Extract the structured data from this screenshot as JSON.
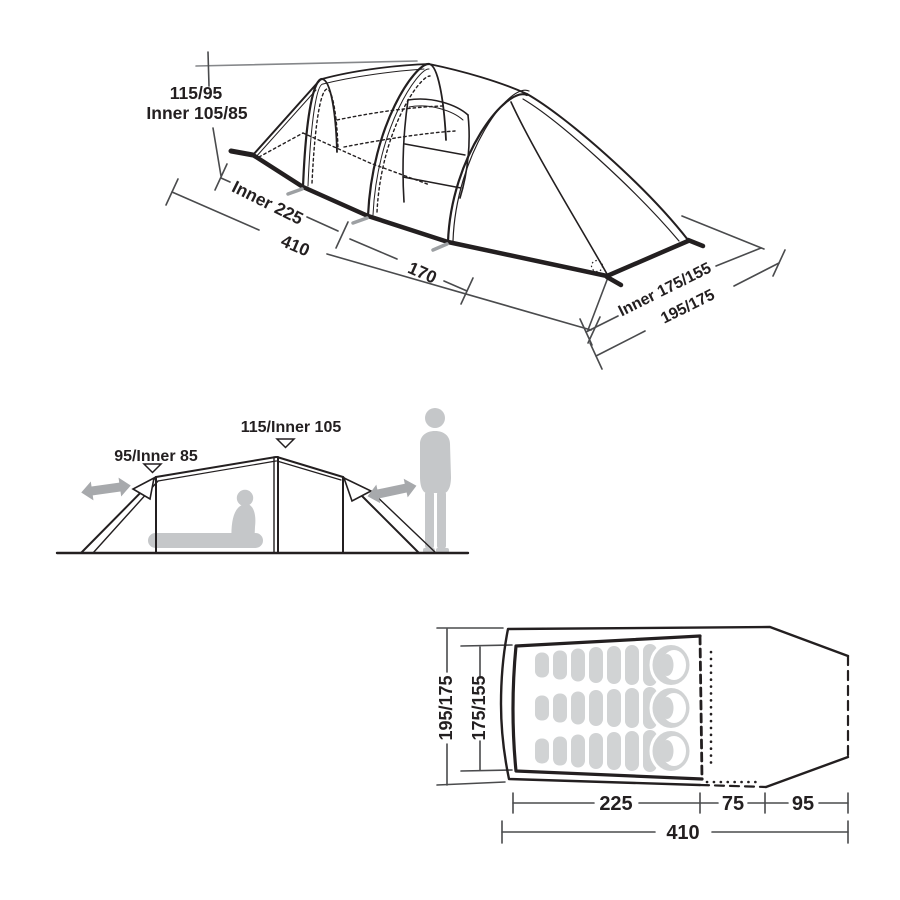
{
  "colors": {
    "line_art": "#231f20",
    "dimension_line": "#4a4b4d",
    "reference_line": "#85878a",
    "silhouette_gray": "#c5c7c9",
    "arrow_gray": "#a7a9ac",
    "sleeping_bag_gray": "#d1d3d4",
    "background": "#ffffff"
  },
  "perspective_view": {
    "peak_height_label": "115/95",
    "inner_height_label": "Inner 105/85",
    "inner_length_label": "Inner 225",
    "total_length_label": "410",
    "porch_length_label": "170",
    "inner_width_label": "Inner 175/155",
    "outer_width_label": "195/175"
  },
  "side_view": {
    "front_pole_height_label": "95/Inner 85",
    "main_pole_height_label": "115/Inner 105"
  },
  "floor_plan": {
    "outer_width_label": "195/175",
    "inner_width_label": "175/155",
    "inner_length_label": "225",
    "door_depth_label": "75",
    "porch_depth_label": "95",
    "total_length_label": "410",
    "sleeping_bag_count": 3
  }
}
